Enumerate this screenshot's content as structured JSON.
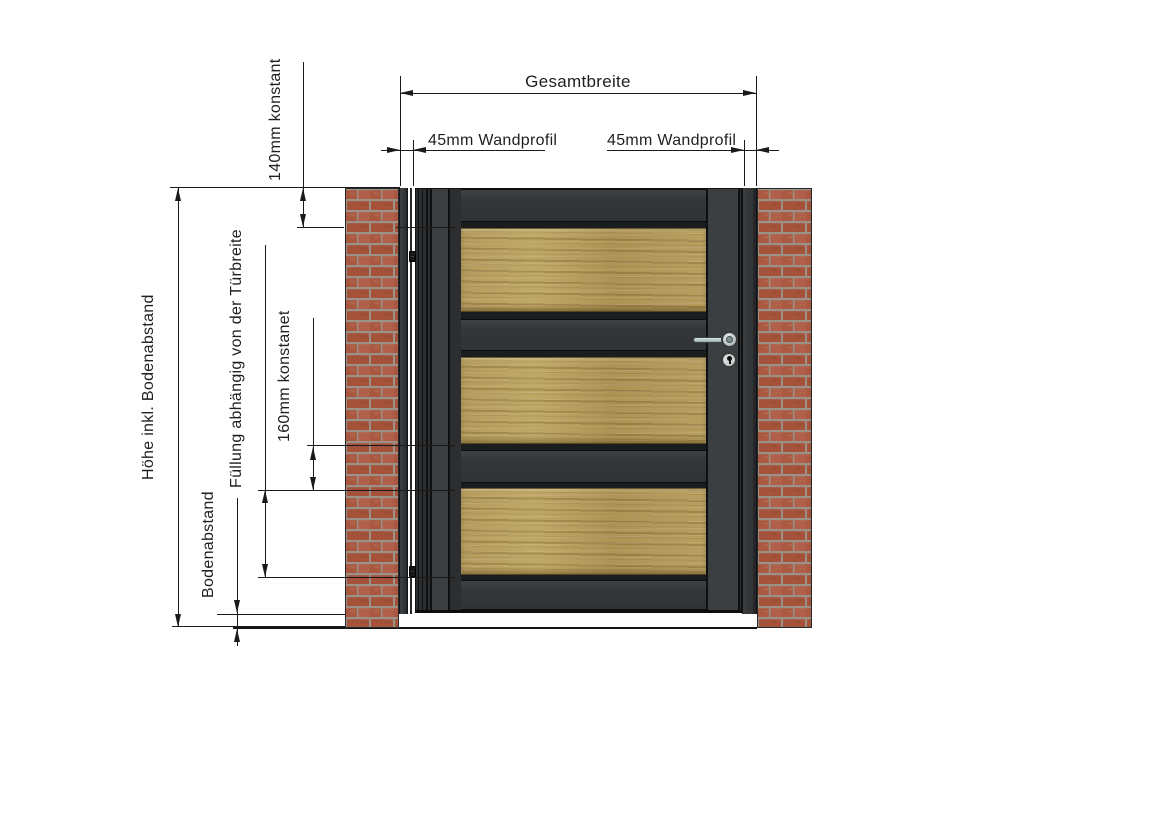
{
  "drawing": {
    "labels": {
      "gesamtbreite": "Gesamtbreite",
      "wandprofil_left": "45mm Wandprofil",
      "wandprofil_right": "45mm Wandprofil",
      "konstant140": "140mm konstant",
      "hoehe": "Höhe inkl. Bodenabstand",
      "fuellung": "Füllung abhängig von der Türbreite",
      "konstant160": "160mm konstanet",
      "bodenabstand": "Bodenabstand"
    },
    "gate": {
      "wood_panels": 3,
      "rails_between_panels": 2,
      "hinges": 2,
      "wall_profile_width_mm": 45,
      "top_rail_mm": 140,
      "middle_rail_mm": 160
    },
    "colors": {
      "dimension_line": "#1a1a1a",
      "frame_dark": "#313335",
      "frame_light": "#3c3f41",
      "wood_base": "#b49a58",
      "brick": "#a9573e",
      "mortar": "#9b9186",
      "handle": "#b9c7c7",
      "background": "#ffffff"
    }
  }
}
